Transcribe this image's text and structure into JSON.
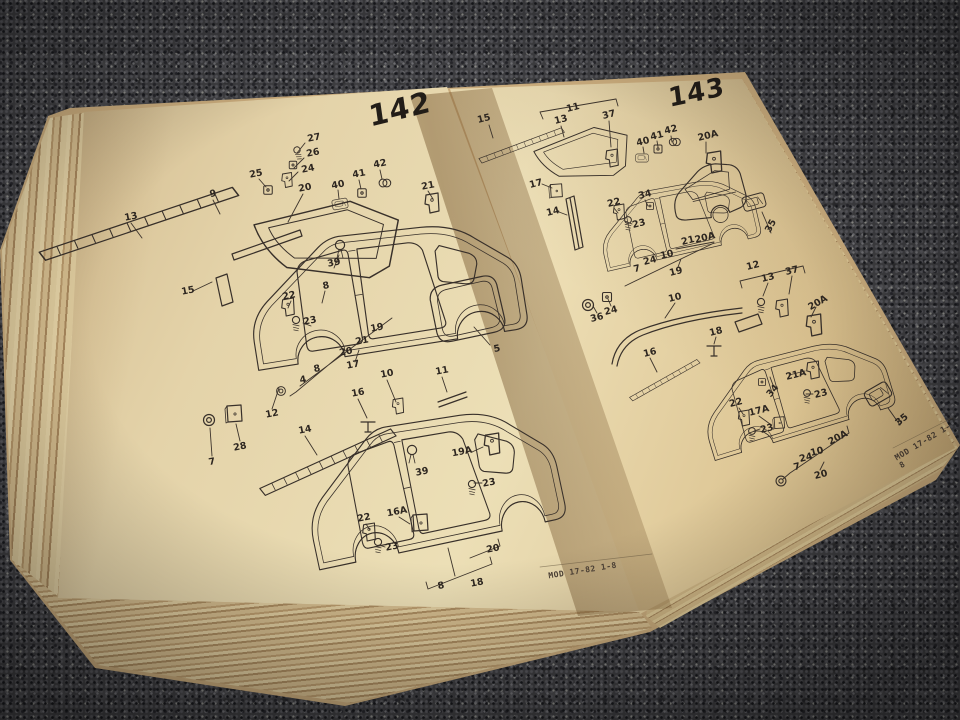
{
  "book": {
    "left_page": {
      "number": "142",
      "footer": "MOD 17-82  1-8",
      "label_rotation": -11,
      "labels": [
        {
          "t": "27",
          "x": 314,
          "y": 138
        },
        {
          "t": "26",
          "x": 313,
          "y": 153
        },
        {
          "t": "24",
          "x": 308,
          "y": 169
        },
        {
          "t": "25",
          "x": 256,
          "y": 174
        },
        {
          "t": "20",
          "x": 305,
          "y": 188
        },
        {
          "t": "40",
          "x": 338,
          "y": 185
        },
        {
          "t": "41",
          "x": 359,
          "y": 174
        },
        {
          "t": "42",
          "x": 380,
          "y": 164
        },
        {
          "t": "21",
          "x": 428,
          "y": 186
        },
        {
          "t": "9",
          "x": 213,
          "y": 194
        },
        {
          "t": "13",
          "x": 131,
          "y": 217
        },
        {
          "t": "15",
          "x": 188,
          "y": 291
        },
        {
          "t": "39",
          "x": 334,
          "y": 263
        },
        {
          "t": "8",
          "x": 326,
          "y": 286
        },
        {
          "t": "22",
          "x": 289,
          "y": 296
        },
        {
          "t": "23",
          "x": 310,
          "y": 321
        },
        {
          "t": "19",
          "x": 377,
          "y": 328
        },
        {
          "t": "21",
          "x": 362,
          "y": 341
        },
        {
          "t": "20",
          "x": 346,
          "y": 352
        },
        {
          "t": "17",
          "x": 353,
          "y": 365
        },
        {
          "t": "8",
          "x": 317,
          "y": 369
        },
        {
          "t": "4",
          "x": 303,
          "y": 380
        },
        {
          "t": "5",
          "x": 497,
          "y": 349
        },
        {
          "t": "12",
          "x": 272,
          "y": 414
        },
        {
          "t": "28",
          "x": 240,
          "y": 447
        },
        {
          "t": "7",
          "x": 212,
          "y": 462
        },
        {
          "t": "14",
          "x": 305,
          "y": 430
        },
        {
          "t": "16",
          "x": 358,
          "y": 393
        },
        {
          "t": "10",
          "x": 387,
          "y": 374
        },
        {
          "t": "11",
          "x": 442,
          "y": 371
        },
        {
          "t": "19A",
          "x": 462,
          "y": 452
        },
        {
          "t": "23",
          "x": 489,
          "y": 483
        },
        {
          "t": "39",
          "x": 422,
          "y": 472
        },
        {
          "t": "16A",
          "x": 397,
          "y": 512
        },
        {
          "t": "22",
          "x": 364,
          "y": 518
        },
        {
          "t": "23",
          "x": 392,
          "y": 547
        },
        {
          "t": "20",
          "x": 493,
          "y": 549
        },
        {
          "t": "18",
          "x": 477,
          "y": 583
        },
        {
          "t": "8",
          "x": 441,
          "y": 586
        }
      ]
    },
    "right_page": {
      "number": "143",
      "footer": "MOD 17-82  1-8",
      "label_rotation": -14,
      "labels": [
        {
          "t": "15",
          "x": 484,
          "y": 119
        },
        {
          "t": "11",
          "x": 573,
          "y": 108
        },
        {
          "t": "13",
          "x": 561,
          "y": 120
        },
        {
          "t": "37",
          "x": 609,
          "y": 115
        },
        {
          "t": "40",
          "x": 643,
          "y": 142
        },
        {
          "t": "41",
          "x": 657,
          "y": 136
        },
        {
          "t": "42",
          "x": 671,
          "y": 130
        },
        {
          "t": "20A",
          "x": 708,
          "y": 136
        },
        {
          "t": "17",
          "x": 536,
          "y": 184
        },
        {
          "t": "14",
          "x": 553,
          "y": 212
        },
        {
          "t": "22",
          "x": 614,
          "y": 203
        },
        {
          "t": "23",
          "x": 639,
          "y": 224
        },
        {
          "t": "34",
          "x": 645,
          "y": 195
        },
        {
          "t": "21",
          "x": 688,
          "y": 241
        },
        {
          "t": "20A",
          "x": 705,
          "y": 238
        },
        {
          "t": "7",
          "x": 637,
          "y": 269
        },
        {
          "t": "24",
          "x": 650,
          "y": 261
        },
        {
          "t": "10",
          "x": 667,
          "y": 255
        },
        {
          "t": "19",
          "x": 676,
          "y": 272
        },
        {
          "t": "35",
          "x": 771,
          "y": 226,
          "r": -62
        },
        {
          "t": "36",
          "x": 597,
          "y": 318
        },
        {
          "t": "24",
          "x": 611,
          "y": 311
        },
        {
          "t": "10",
          "x": 675,
          "y": 298
        },
        {
          "t": "12",
          "x": 753,
          "y": 266
        },
        {
          "t": "13",
          "x": 768,
          "y": 278
        },
        {
          "t": "37",
          "x": 792,
          "y": 271
        },
        {
          "t": "20A",
          "x": 818,
          "y": 303,
          "r": -30
        },
        {
          "t": "18",
          "x": 716,
          "y": 332
        },
        {
          "t": "16",
          "x": 650,
          "y": 353
        },
        {
          "t": "34",
          "x": 773,
          "y": 391,
          "r": -50
        },
        {
          "t": "21A",
          "x": 796,
          "y": 375
        },
        {
          "t": "23",
          "x": 821,
          "y": 394
        },
        {
          "t": "22",
          "x": 736,
          "y": 403
        },
        {
          "t": "17A",
          "x": 759,
          "y": 411
        },
        {
          "t": "23",
          "x": 767,
          "y": 429
        },
        {
          "t": "7",
          "x": 797,
          "y": 467
        },
        {
          "t": "24",
          "x": 806,
          "y": 458
        },
        {
          "t": "10",
          "x": 817,
          "y": 452
        },
        {
          "t": "20A",
          "x": 838,
          "y": 438,
          "r": -28
        },
        {
          "t": "20",
          "x": 821,
          "y": 475
        },
        {
          "t": "35",
          "x": 902,
          "y": 420,
          "r": -40
        }
      ]
    }
  },
  "colors": {
    "carpet": "#3e3e41",
    "page_cream": "#ecdfb6",
    "page_edge": "#b6976a",
    "ink": "#38302a"
  }
}
